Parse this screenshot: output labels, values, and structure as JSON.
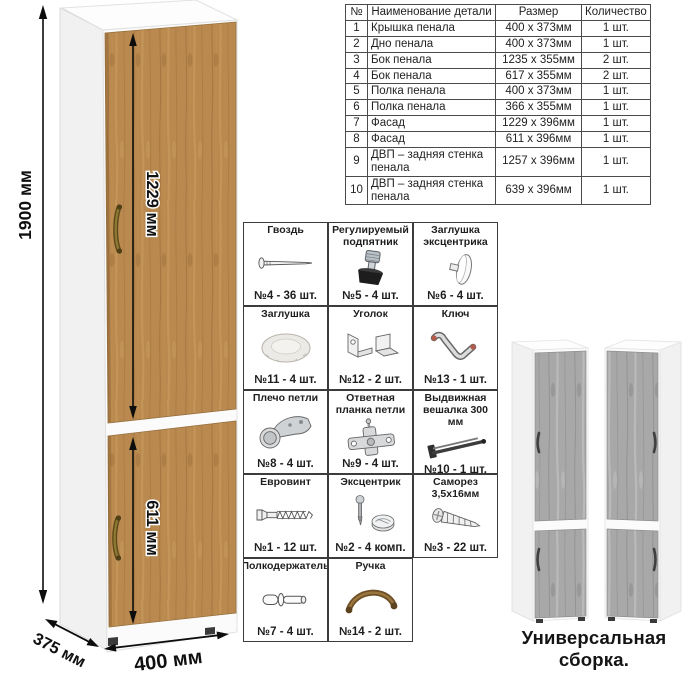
{
  "cabinet": {
    "height_label": "1900 мм",
    "upper_door_label": "1229 мм",
    "lower_door_label": "611 мм",
    "width_label": "400 мм",
    "depth_label": "375 мм"
  },
  "colors": {
    "wood": "#b9894f",
    "wood_streak": "#9d6f3a",
    "gray_wood": "#a8a8a8",
    "carcass_white": "#fcfcfc",
    "border": "#3c3c3c",
    "text": "#1d1d1d",
    "handle_bronze": "#6e4f26"
  },
  "parts_table": {
    "headers": [
      "№",
      "Наименование детали",
      "Размер",
      "Количество"
    ],
    "rows": [
      {
        "num": "1",
        "name": "Крышка пенала",
        "size": "400 х 373мм",
        "qty": "1 шт."
      },
      {
        "num": "2",
        "name": "Дно пенала",
        "size": "400 х 373мм",
        "qty": "1 шт."
      },
      {
        "num": "3",
        "name": "Бок пенала",
        "size": "1235 х 355мм",
        "qty": "2 шт."
      },
      {
        "num": "4",
        "name": "Бок пенала",
        "size": "617 х 355мм",
        "qty": "2 шт."
      },
      {
        "num": "5",
        "name": "Полка пенала",
        "size": "400 х 373мм",
        "qty": "1 шт."
      },
      {
        "num": "6",
        "name": "Полка пенала",
        "size": "366 х 355мм",
        "qty": "1 шт."
      },
      {
        "num": "7",
        "name": "Фасад",
        "size": "1229 х 396мм",
        "qty": "1 шт."
      },
      {
        "num": "8",
        "name": "Фасад",
        "size": "611 х 396мм",
        "qty": "1 шт."
      },
      {
        "num": "9",
        "name": "ДВП – задняя стенка пенала",
        "size": "1257 х 396мм",
        "qty": "1 шт."
      },
      {
        "num": "10",
        "name": "ДВП – задняя стенка пенала",
        "size": "639 х 396мм",
        "qty": "1 шт."
      }
    ]
  },
  "hardware": {
    "items": [
      {
        "title": "Гвоздь",
        "qty": "№4 - 36 шт.",
        "icon": "nail-icon"
      },
      {
        "title": "Регулируемый подпятник",
        "qty": "№5 - 4 шт.",
        "icon": "adjustable-foot-icon"
      },
      {
        "title": "Заглушка эксцентрика",
        "qty": "№6 - 4 шт.",
        "icon": "eccentric-cap-icon"
      },
      {
        "title": "Заглушка",
        "qty": "№11 - 4 шт.",
        "icon": "plug-cap-icon"
      },
      {
        "title": "Уголок",
        "qty": "№12 - 2 шт.",
        "icon": "corner-bracket-icon"
      },
      {
        "title": "Ключ",
        "qty": "№13 - 1 шт.",
        "icon": "key-icon"
      },
      {
        "title": "Плечо петли",
        "qty": "№8 - 4 шт.",
        "icon": "hinge-arm-icon"
      },
      {
        "title": "Ответная планка петли",
        "qty": "№9 - 4 шт.",
        "icon": "hinge-plate-icon"
      },
      {
        "title": "Выдвижная вешалка 300 мм",
        "qty": "№10 - 1 шт.",
        "icon": "pullout-hanger-icon"
      },
      {
        "title": "Евровинт",
        "qty": "№1 - 12 шт.",
        "icon": "euro-screw-icon"
      },
      {
        "title": "Эксцентрик",
        "qty": "№2 - 4 комп.",
        "icon": "eccentric-cam-icon"
      },
      {
        "title": "Саморез 3,5х16мм",
        "qty": "№3 - 22 шт.",
        "icon": "self-tapping-screw-icon"
      },
      {
        "title": "Полкодержатель",
        "qty": "№7 - 4 шт.",
        "icon": "shelf-pin-icon"
      },
      {
        "title": "Ручка",
        "qty": "№14 - 2 шт.",
        "icon": "handle-icon"
      }
    ]
  },
  "footer": {
    "caption": "Универсальная сборка."
  }
}
